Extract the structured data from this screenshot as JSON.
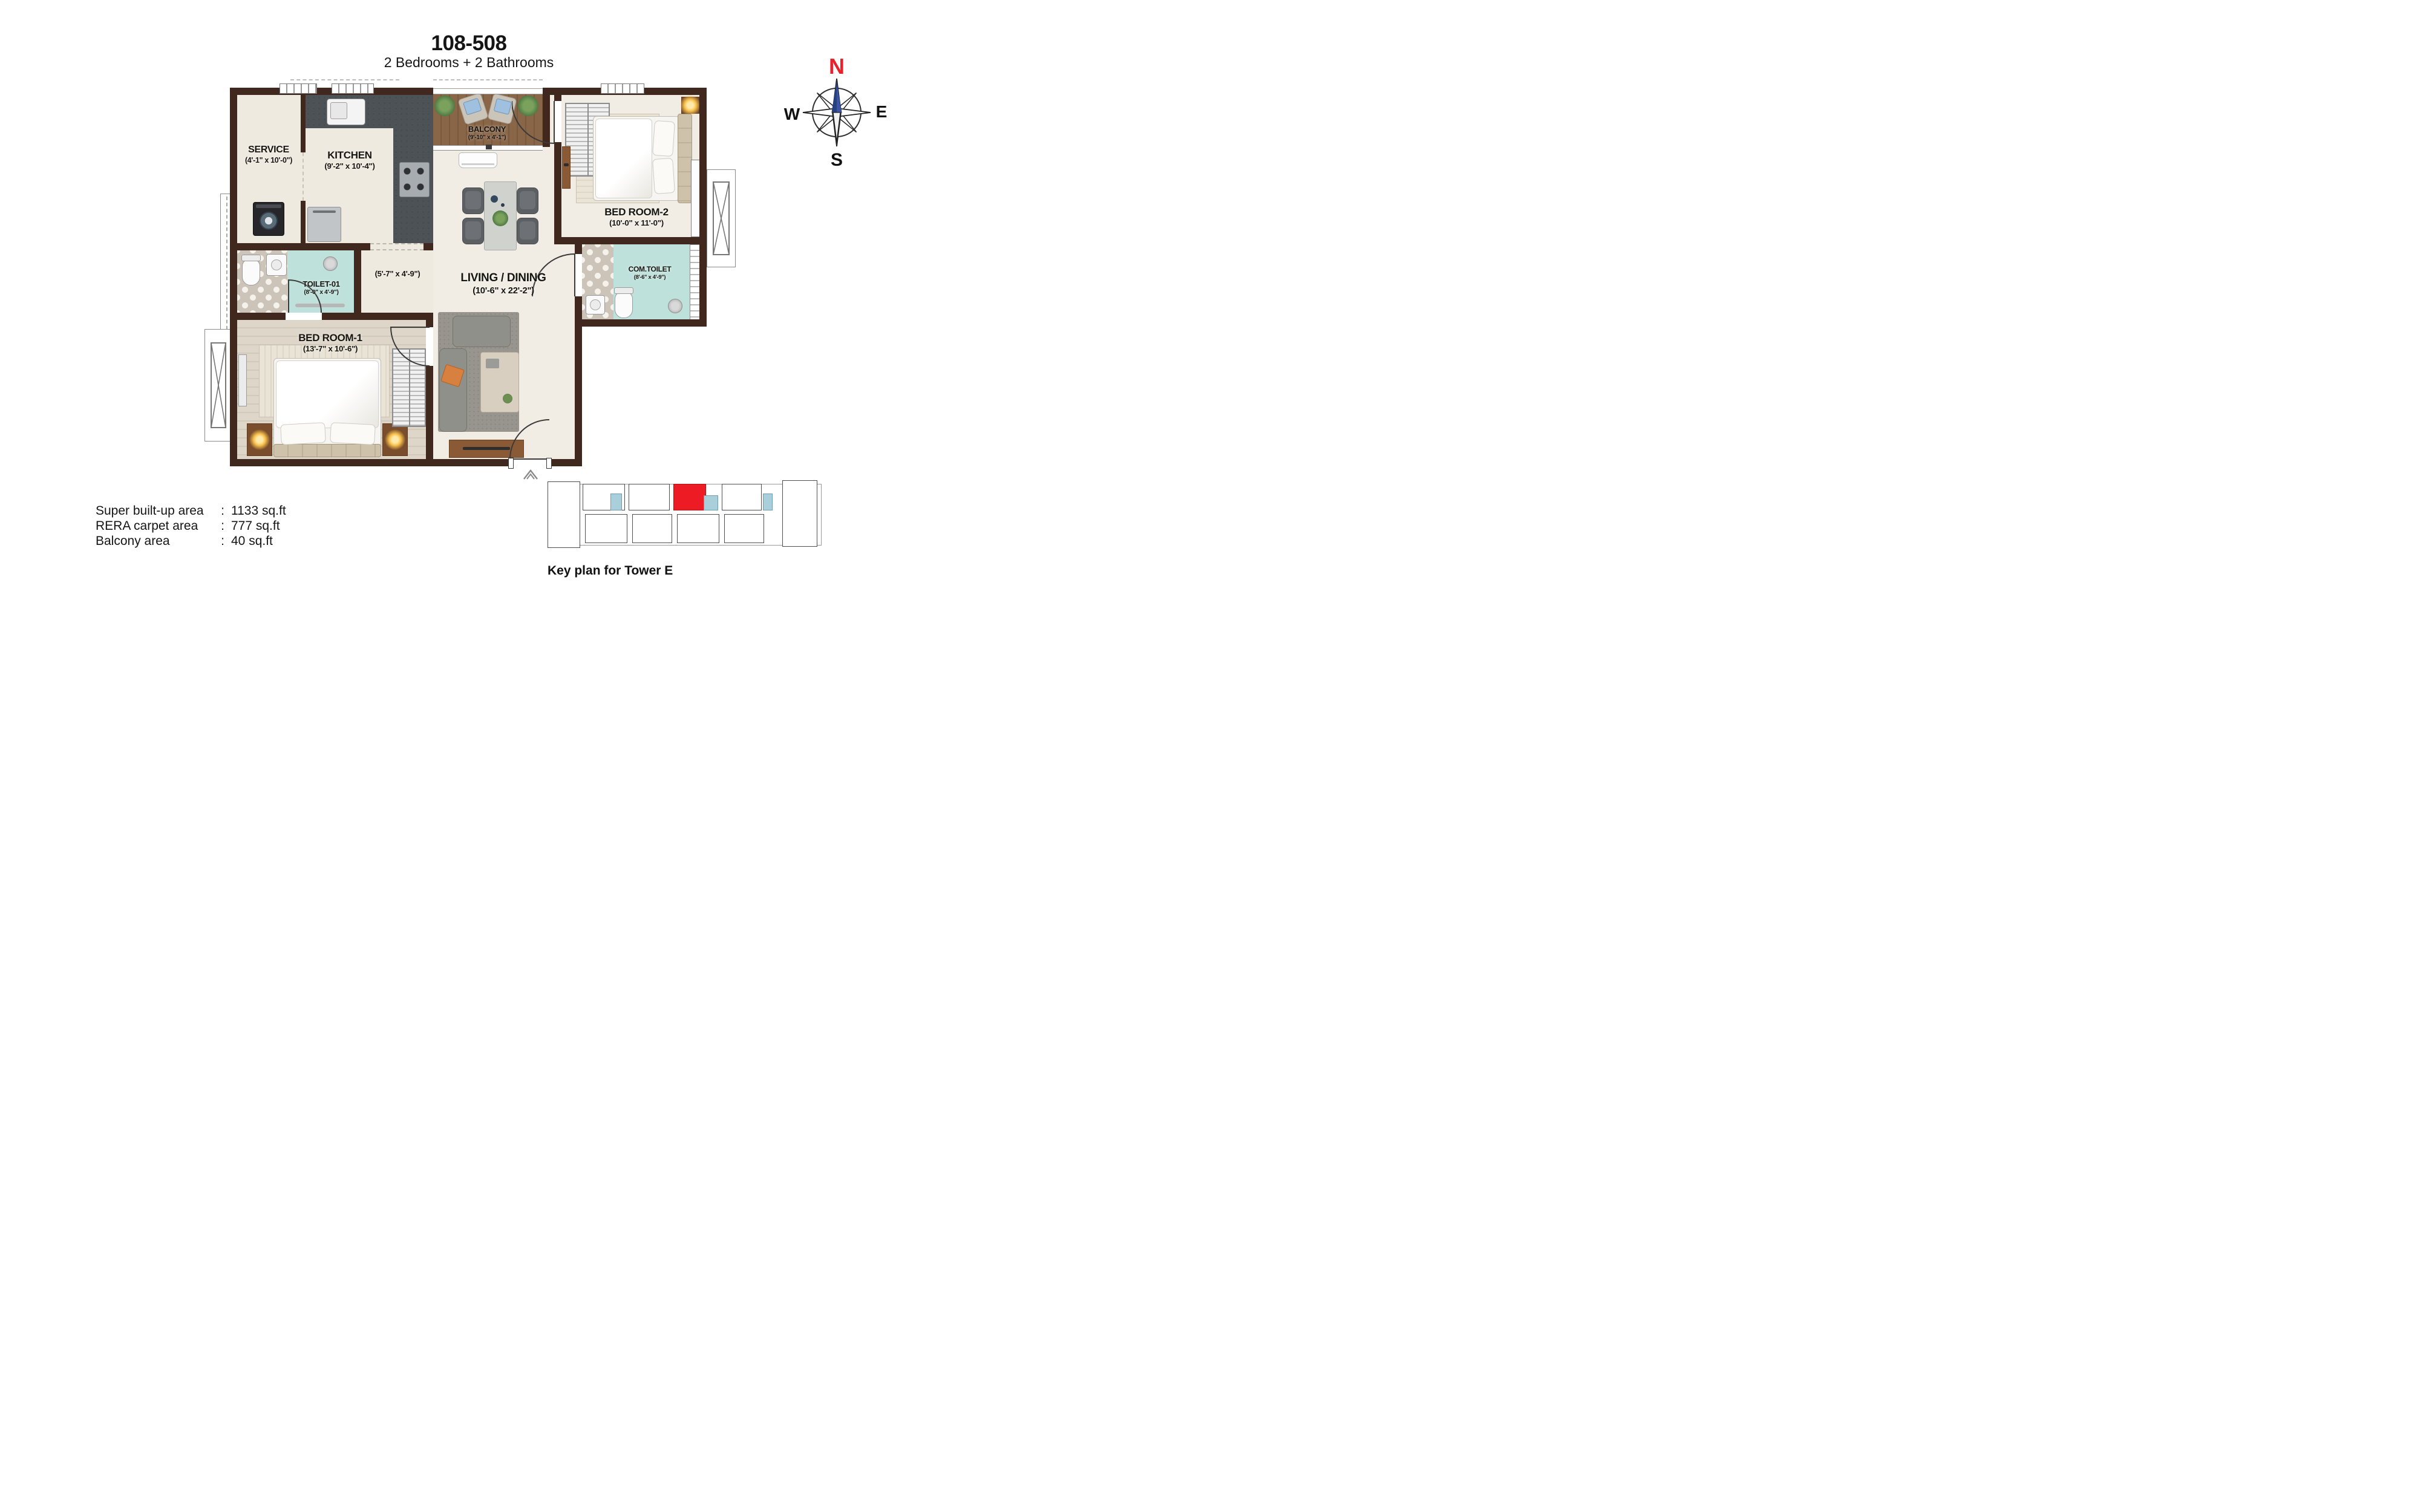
{
  "header": {
    "title": "108-508",
    "subtitle": "2 Bedrooms + 2 Bathrooms"
  },
  "compass": {
    "north": "N",
    "south": "S",
    "east": "E",
    "west": "W"
  },
  "rooms": {
    "service": {
      "name": "SERVICE",
      "dims": "(4'-1\" x 10'-0\")"
    },
    "kitchen": {
      "name": "KITCHEN",
      "dims": "(9'-2\" x 10'-4\")"
    },
    "balcony": {
      "name": "BALCONY",
      "dims": "(9'-10\" x 4'-1\")"
    },
    "bedroom2": {
      "name": "BED ROOM-2",
      "dims": "(10'-0\" x 11'-0\")"
    },
    "toilet1": {
      "name": "TOILET-01",
      "dims": "(8'-0\" x 4'-9\")"
    },
    "passage": {
      "dims": "(5'-7\" x 4'-9\")"
    },
    "living": {
      "name": "LIVING / DINING",
      "dims": "(10'-6\" x 22'-2\")"
    },
    "comtoilet": {
      "name": "COM.TOILET",
      "dims": "(8'-6\" x 4'-9\")"
    },
    "bedroom1": {
      "name": "BED ROOM-1",
      "dims": "(13'-7\" x 10'-6\")"
    }
  },
  "areas": {
    "rows": [
      {
        "label": "Super built-up area",
        "colon": ":",
        "value": "1133 sq.ft"
      },
      {
        "label": "RERA carpet area",
        "colon": ":",
        "value": "777 sq.ft"
      },
      {
        "label": "Balcony area",
        "colon": ":",
        "value": "40 sq.ft"
      }
    ]
  },
  "keyplan": {
    "caption": "Key plan for Tower E"
  },
  "colors": {
    "wall": "#40281f",
    "toilet_floor": "#bfe1dc",
    "balcony_wood": "#8a6648",
    "highlight_unit_red": "#ed1c24",
    "keyplan_core_teal": "#a9cfda",
    "compass_north_red": "#e8212a",
    "compass_needle_blue": "#3b55a3"
  }
}
